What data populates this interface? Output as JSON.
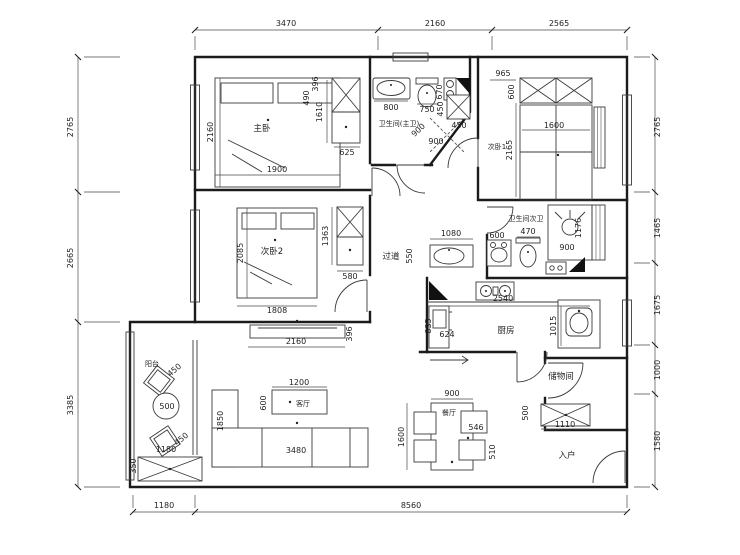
{
  "rooms": {
    "master": "主卧",
    "bedroom2": "次卧2",
    "bedroom1": "次卧1",
    "master_bath": "卫生间(主卫)",
    "second_bath": "卫生间次卫",
    "hallway": "过道",
    "kitchen": "厨房",
    "living": "客厅",
    "dining": "餐厅",
    "storage": "储物间",
    "balcony": "阳台",
    "entry": "入户"
  },
  "dims": {
    "top": [
      "3470",
      "2160",
      "2565"
    ],
    "left": [
      "2765",
      "2665",
      "3385"
    ],
    "right": [
      "2765",
      "1465",
      "1675",
      "1000",
      "1580"
    ],
    "bottom": [
      "1180",
      "8560"
    ],
    "master": {
      "bed_depth": "2160",
      "bed_width": "1900",
      "nightstand": "490",
      "shelf": "396",
      "wardrobe_len": "1610",
      "wardrobe_depth": "625"
    },
    "master_bath": {
      "tub": "800",
      "toilet_width": "750",
      "toilet_depth": "670",
      "shower_a": "900",
      "shower_b": "900"
    },
    "bedroom1": {
      "cabinet_width": "965",
      "cabinet_depth": "600",
      "side_cabinet_w": "450",
      "side_cabinet_d": "450",
      "bed_width": "1600",
      "bed_length": "2165"
    },
    "bedroom2": {
      "bed_depth": "2085",
      "bed_width": "1808",
      "wardrobe_len": "1363",
      "wardrobe_depth": "580"
    },
    "hallway": {
      "basin_width": "1080",
      "basin_depth": "550"
    },
    "second_bath": {
      "basin": "600",
      "toilet": "470",
      "shower_width": "900",
      "shower_length": "1176"
    },
    "kitchen": {
      "counter": "2540",
      "depth": "1015",
      "cabinet_width": "624",
      "cabinet_depth": "835"
    },
    "living": {
      "tv_cabinet": "2160",
      "tv_depth": "396",
      "table_width": "1200",
      "table_depth": "600",
      "sofa": "3480",
      "room_width": "1850"
    },
    "balcony": {
      "chair_a": "450",
      "table": "500",
      "chair_b": "450",
      "cabinet_width": "1180",
      "cabinet_depth": "350"
    },
    "dining": {
      "table_width": "900",
      "area_length": "1600",
      "chair_width": "546",
      "chair_depth": "510"
    },
    "storage": {
      "cabinet_depth": "500",
      "cabinet_width": "1110"
    }
  }
}
